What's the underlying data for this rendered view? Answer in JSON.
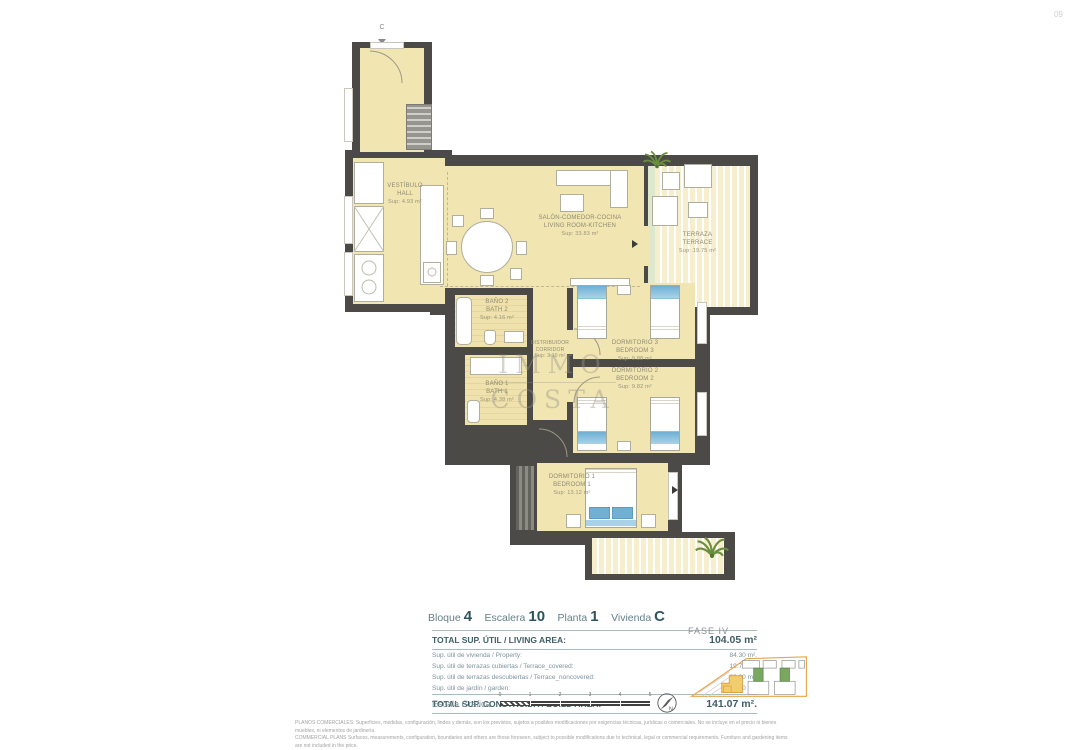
{
  "page": {
    "number": "09"
  },
  "plan": {
    "entry_marker": "C",
    "watermark": {
      "line1": "IMMO",
      "line2": "COSTA"
    },
    "rooms": {
      "vestibulo": {
        "name_es": "VESTÍBULO",
        "name_en": "HALL",
        "area": "Sup: 4.93 m²"
      },
      "salon": {
        "name_es": "SALÓN-COMEDOR-COCINA",
        "name_en": "LIVING ROOM-KITCHEN",
        "area": "Sup: 33.83 m²"
      },
      "terraza": {
        "name_es": "TERRAZA",
        "name_en": "TERRACE",
        "area": "Sup: 19.75 m²"
      },
      "bano2": {
        "name_es": "BAÑO 2",
        "name_en": "BATH 2",
        "area": "Sup: 4.16 m²"
      },
      "distribuidor": {
        "name_es": "DISTRIBUIDOR",
        "name_en": "CORRIDOR",
        "area": "Sup: 3.10 m²"
      },
      "dormitorio3": {
        "name_es": "DORMITORIO 3",
        "name_en": "BEDROOM 3",
        "area": "Sup: 9.88 m²"
      },
      "dormitorio2": {
        "name_es": "DORMITORIO 2",
        "name_en": "BEDROOM 2",
        "area": "Sup: 9.82 m²"
      },
      "bano1": {
        "name_es": "BAÑO 1",
        "name_en": "BATH 1",
        "area": "Sup: 4.38 m²"
      },
      "dormitorio1": {
        "name_es": "DORMITORIO 1",
        "name_en": "BEDROOM 1",
        "area": "Sup: 13.12 m²"
      }
    }
  },
  "info": {
    "unit": {
      "bloque_label": "Bloque",
      "bloque_value": "4",
      "escalera_label": "Escalera",
      "escalera_value": "10",
      "planta_label": "Planta",
      "planta_value": "1",
      "vivienda_label": "Vivienda",
      "vivienda_value": "C"
    },
    "areas": {
      "total_util_label": "TOTAL SUP. ÚTIL / LIVING AREA:",
      "total_util_value": "104.05 m²",
      "rows": [
        {
          "label": "Sup. útil de vivienda / Property:",
          "value": "84.30 m²."
        },
        {
          "label": "Sup. útil de terrazas cubiertas / Terrace_covered:",
          "value": "19.75 m²."
        },
        {
          "label": "Sup. útil de terrazas descubiertas / Terrace_noncovered:",
          "value": "00.00 m²."
        },
        {
          "label": "Sup. útil de jardín / garden:",
          "value": "00.00 m²."
        }
      ],
      "total_build_label": "TOTAL SUP. CONSTRUIDA / BUILD AREA:",
      "total_build_value": "141.07 m²."
    },
    "scale": {
      "label": "Escala Gráfica",
      "ticks": [
        "0",
        "1",
        "2",
        "3",
        "4",
        "5"
      ]
    },
    "fase": {
      "label": "FASE IV"
    }
  },
  "footer": {
    "line_es": "PLANOS COMERCIALES: Superficies, medidas, configuración, lindes y demás, son los previstos, sujetos a posibles modificaciones por exigencias técnicas, jurídicas o comerciales. No se incluye en el precio ni bienes muebles, ni elementos de jardinería.",
    "line_en": "COMMERCIAL PLANS Surfaces, measurements, configuration, boundaries and others are those foreseen, subject to possible modifications due to technical, legal or commercial requirements. Furniture and gardening items are not included in the price."
  },
  "colors": {
    "wall": "#4b4a46",
    "floor": "#f1e5b2",
    "accent_teal": "#3f5f66",
    "bed_blue": "#6fb0d4",
    "site_orange": "#e8a54a",
    "site_green": "#7aa861",
    "site_yellow": "#f2cd6e"
  }
}
